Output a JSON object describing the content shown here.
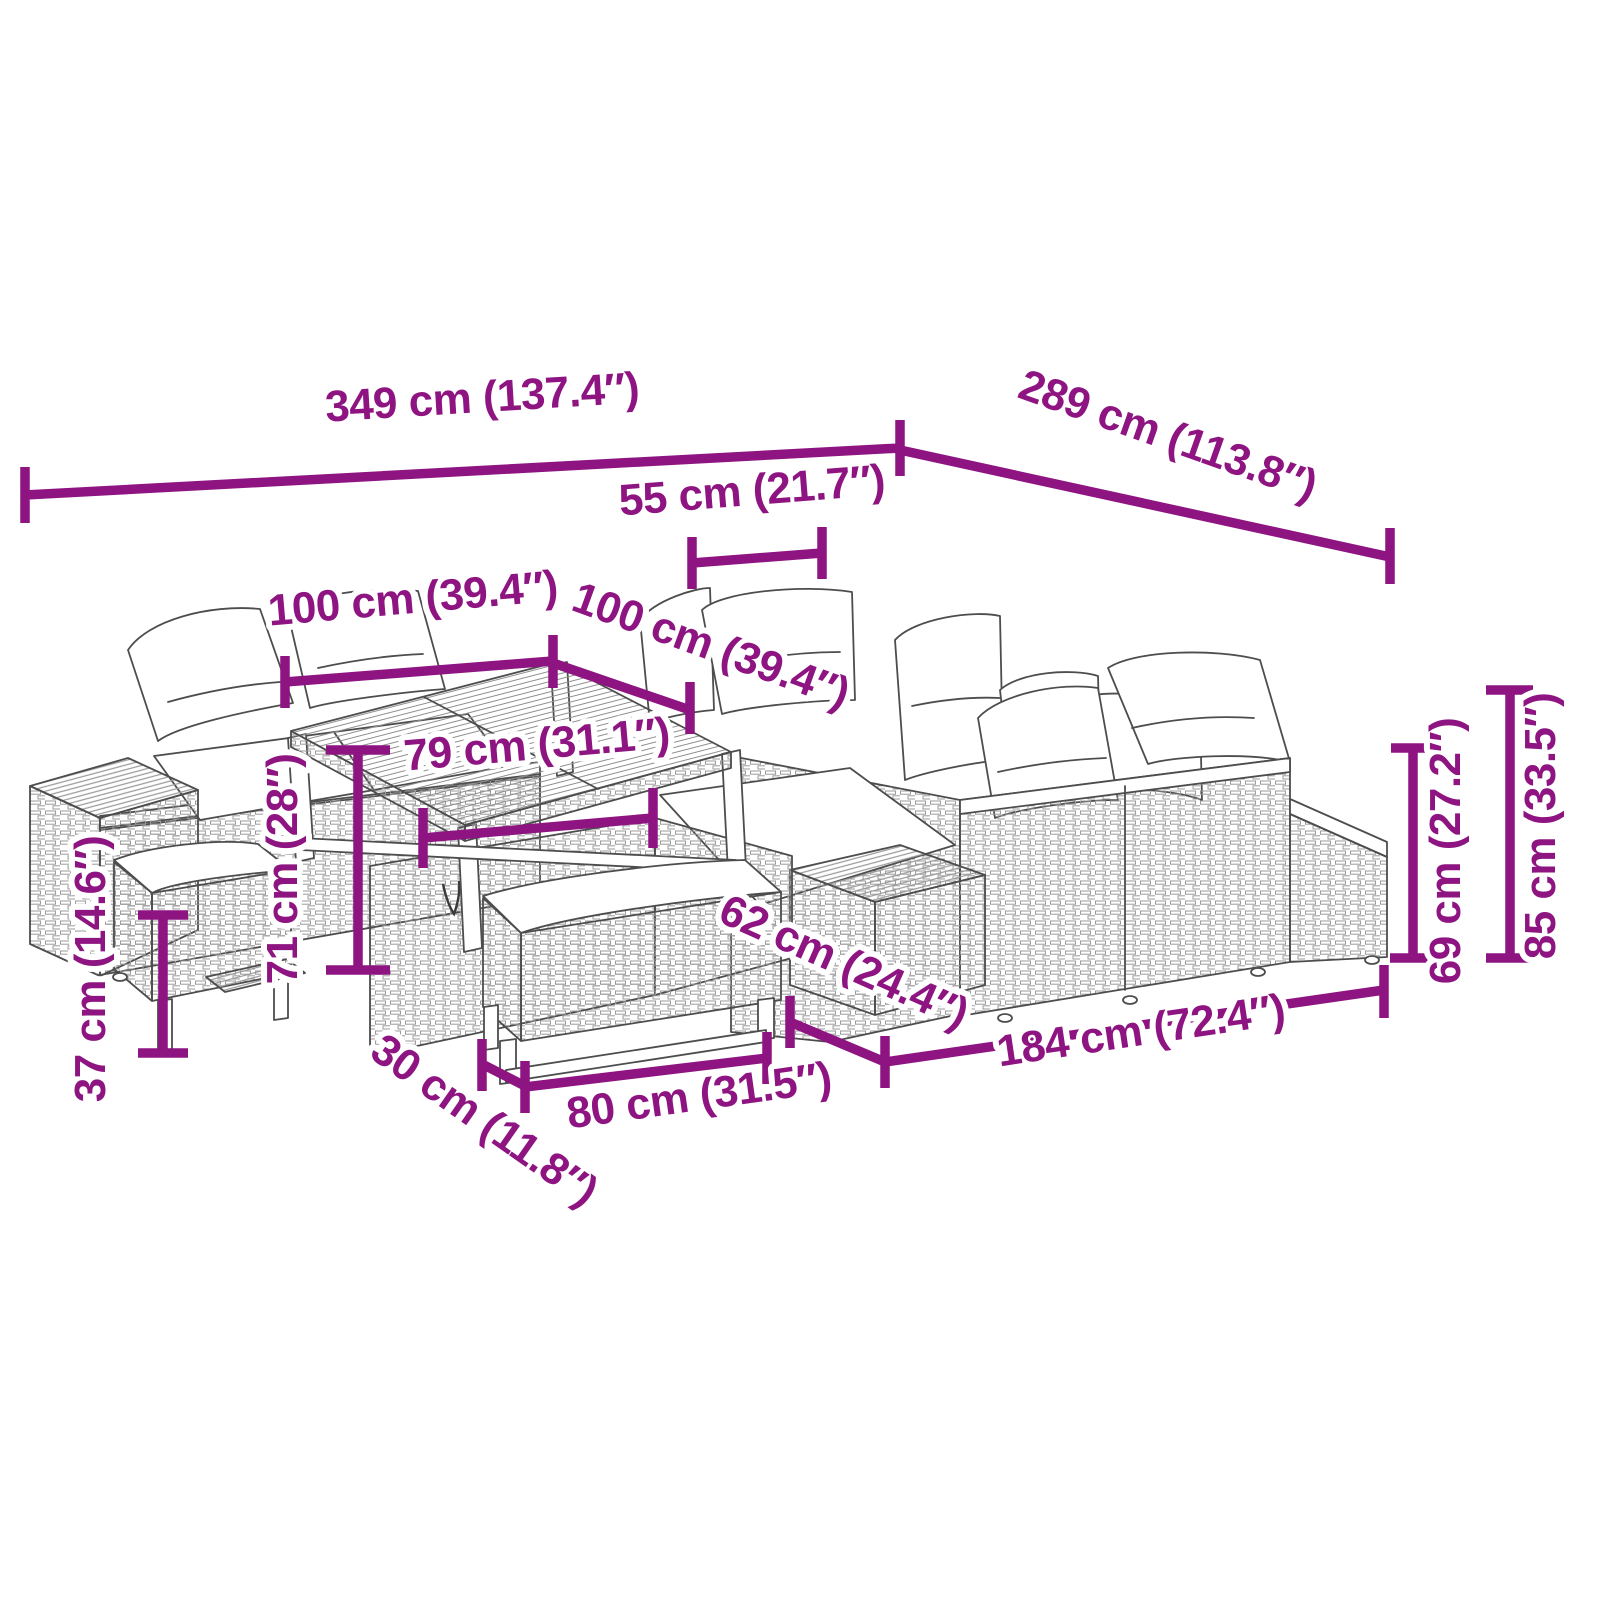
{
  "diagram": {
    "kind": "product-dimension-diagram",
    "subject": "garden lounge furniture set line drawing",
    "accent_color": "#8E1482",
    "art_color": "#4D4D4D",
    "background_color": "#FFFFFF",
    "unit_primary": "cm",
    "unit_secondary": "inches",
    "dimensions": {
      "overall_width": "349 cm (137.4″)",
      "overall_depth": "289 cm (113.8″)",
      "back_cushion_width": "55 cm (21.7″)",
      "table_length": "100 cm (39.4″)",
      "table_width": "100 cm (39.4″)",
      "table_frame_width": "79 cm (31.1″)",
      "table_height": "71 cm (28″)",
      "bench_seat_height": "37 cm (14.6″)",
      "bench_depth": "30 cm (11.8″)",
      "bench_length": "80 cm (31.5″)",
      "ottoman_depth": "62 cm (24.4″)",
      "sofa_length": "184 cm (72.4″)",
      "armrest_height": "69 cm (27.2″)",
      "back_height": "85 cm (33.5″)"
    }
  }
}
